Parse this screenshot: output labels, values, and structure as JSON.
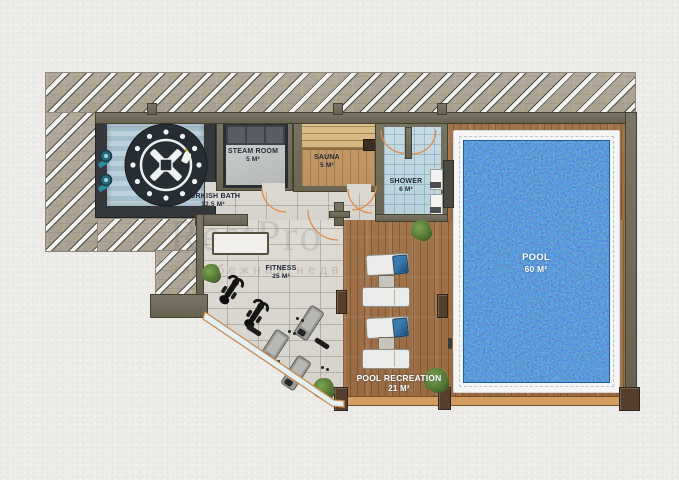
{
  "watermark": {
    "brand": "RestPro",
    "tagline": "Зарубежная недвижимость"
  },
  "rooms": {
    "turkish_bath": {
      "name": "TURKISH BATH",
      "area": "12,5 M²"
    },
    "steam_room": {
      "name": "STEAM ROOM",
      "area": "5 M²"
    },
    "sauna": {
      "name": "SAUNA",
      "area": "5 M²"
    },
    "shower": {
      "name": "SHOWER",
      "area": "6 M²"
    },
    "fitness": {
      "name": "FITNESS",
      "area": "25 M²"
    },
    "pool": {
      "name": "POOL",
      "area": "60 M²"
    },
    "pool_recreation": {
      "name": "POOL RECREATION",
      "area": "21 M²"
    }
  },
  "colors": {
    "pool_water": "#2273bd",
    "deck_wood": "#a1744b",
    "wall_olive": "#6f6b5c",
    "turkish_wall": "#34383a",
    "door_accent": "#e08a4e",
    "hatch_stone": "#b2a99b"
  }
}
